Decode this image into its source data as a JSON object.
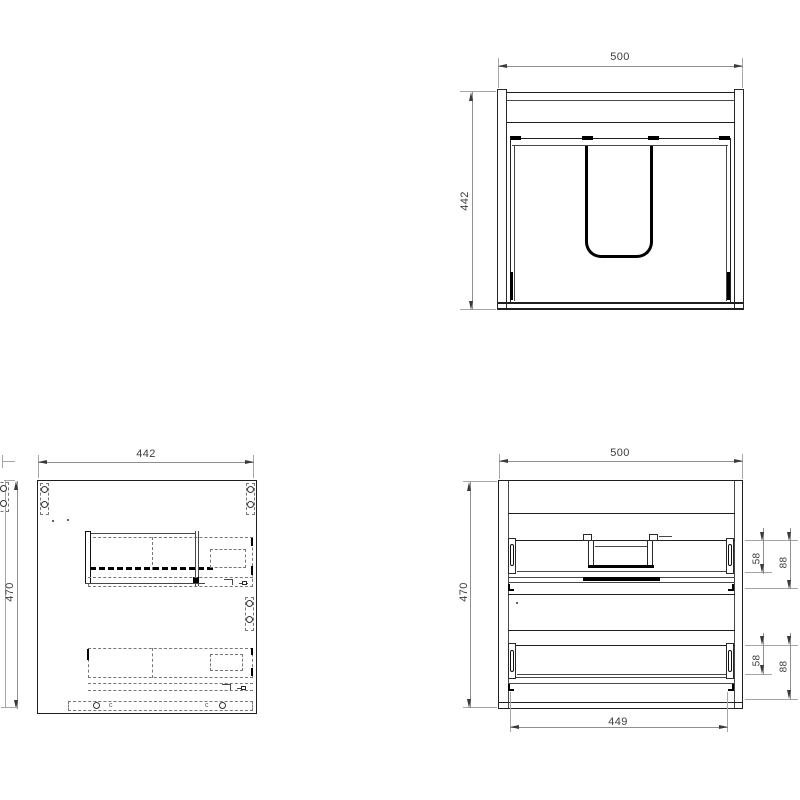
{
  "views": {
    "plan": {
      "dim_width": "500",
      "dim_depth": "442"
    },
    "side": {
      "dim_depth": "442",
      "dim_height": "470",
      "markers": {
        "left": "c",
        "right": "c"
      }
    },
    "rear": {
      "dim_width": "500",
      "dim_height": "470",
      "dim_drawer_span": "449",
      "upper_drawer": {
        "dim_back": "58",
        "dim_total": "88"
      },
      "lower_drawer": {
        "dim_back": "58",
        "dim_total": "88"
      }
    }
  },
  "colors": {
    "background": "#ffffff",
    "object_line": "#1f1f1f",
    "hidden_line": "#777777",
    "dimension_line": "#8f8f8f",
    "label_text": "#3d3d3d"
  }
}
